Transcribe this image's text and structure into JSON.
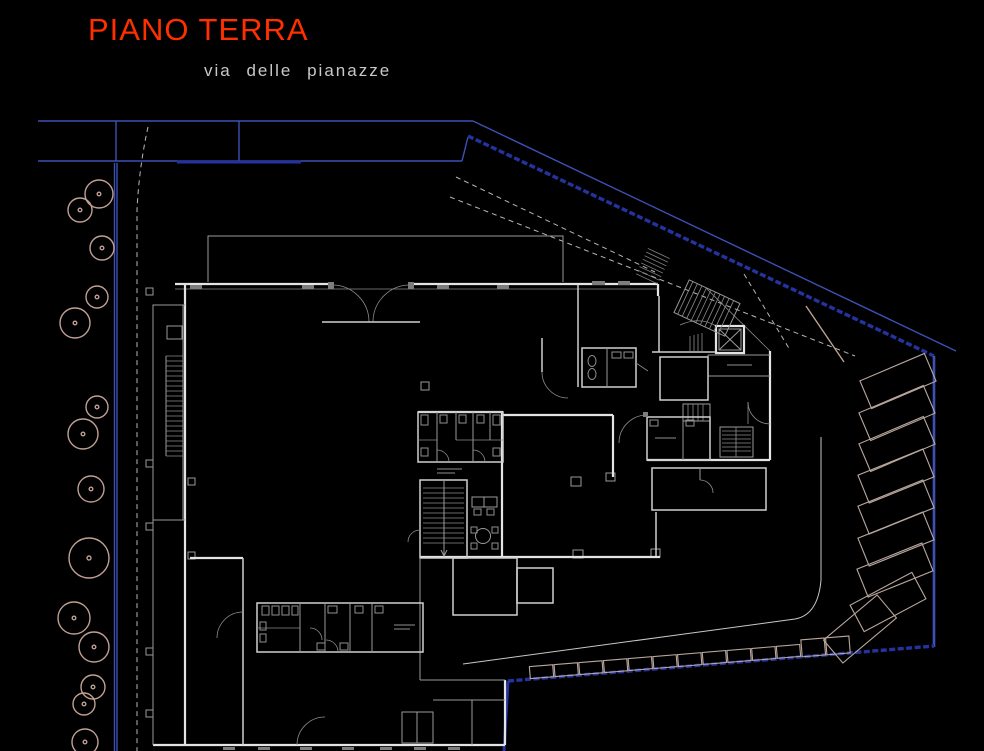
{
  "header": {
    "title": "PIANO TERRA",
    "street_label": "via delle pianazze"
  },
  "colors": {
    "background": "#000000",
    "title_red": "#ff2f00",
    "street_text": "#c8c8c8",
    "road_blue": "#3d50b5",
    "road_blue_dark": "#2533a0",
    "wall": "#e4e4e4",
    "detail": "#9a9a9a",
    "vegetation": "#bfa094",
    "parking": "#b9a79e"
  },
  "site": {
    "floor_shown": "ground floor plan",
    "tree_count": 14,
    "angled_parking_spaces": 9,
    "street_parking_spaces": 13
  }
}
